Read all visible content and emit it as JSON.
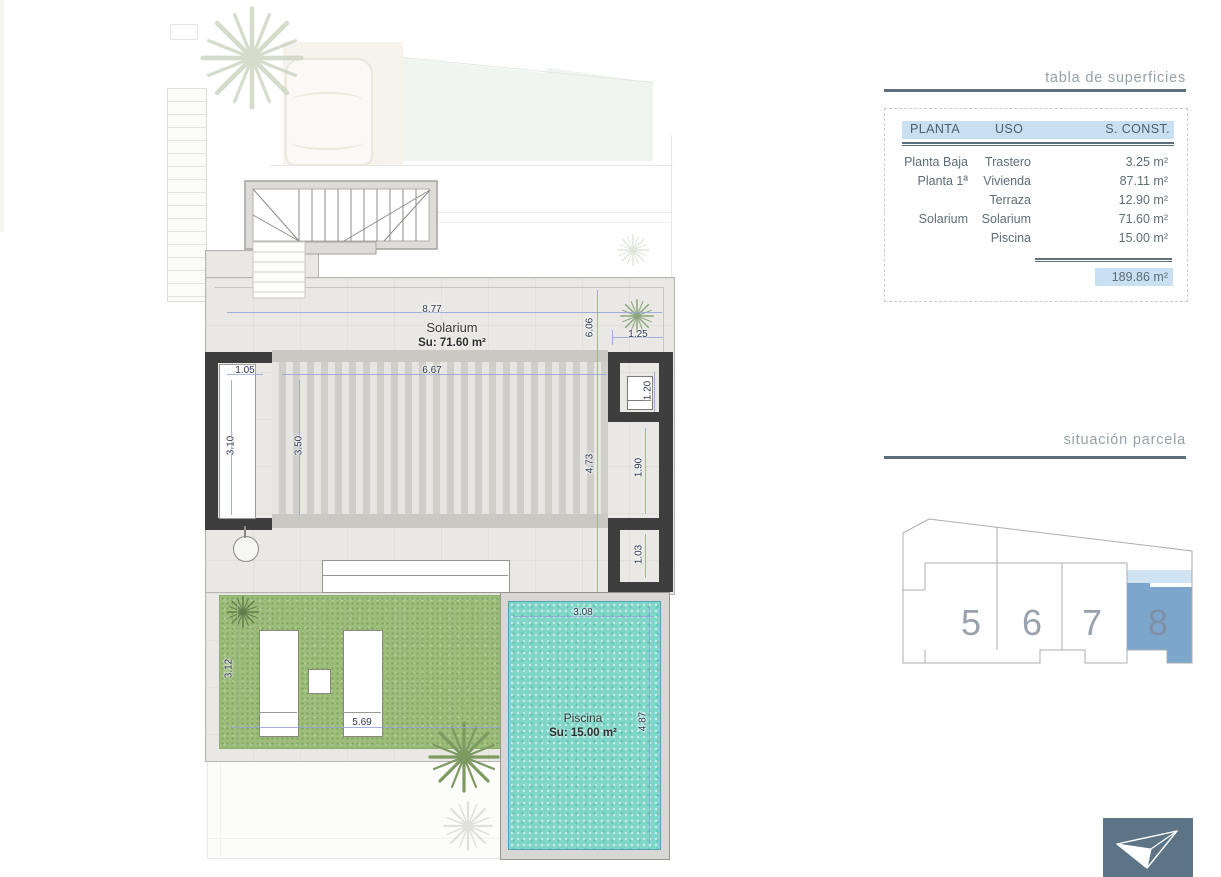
{
  "plan": {
    "rooms": {
      "solarium_label": "Solarium",
      "solarium_area": "Su: 71.60 m²",
      "pool_label": "Piscina",
      "pool_area": "Su: 15.00 m²"
    },
    "dims": {
      "d877": "8.77",
      "d606": "6.06",
      "d125": "1.25",
      "d667": "6.67",
      "d105": "1.05",
      "d310": "3.10",
      "d350": "3.50",
      "d473": "4.73",
      "d190": "1.90",
      "d120": "1.20",
      "d103": "1.03",
      "d308": "3.08",
      "d312": "3.12",
      "d569": "5.69",
      "d487": "4.87"
    }
  },
  "surfaces_table": {
    "title": "tabla de superficies",
    "columns": [
      "PLANTA",
      "USO",
      "S. CONST."
    ],
    "rows": [
      {
        "planta": "Planta Baja",
        "uso": "Trastero",
        "sconst": "3.25 m²"
      },
      {
        "planta": "Planta 1ª",
        "uso": "Vivienda",
        "sconst": "87.11 m²"
      },
      {
        "planta": "",
        "uso": "Terraza",
        "sconst": "12.90 m²"
      },
      {
        "planta": "Solarium",
        "uso": "Solarium",
        "sconst": "71.60 m²"
      },
      {
        "planta": "",
        "uso": "Piscina",
        "sconst": "15.00 m²"
      }
    ],
    "total": "189.86 m²"
  },
  "parcela": {
    "title": "situación parcela",
    "plots": [
      "5",
      "6",
      "7",
      "8"
    ],
    "highlighted_plot": "8"
  },
  "colors": {
    "accent_blue": "#c8e0f1",
    "plot_highlight": "#7ca6cb",
    "plot_highlight_light": "#cfe3f2",
    "pool": "#7fd6c7",
    "lawn": "#9dbd7a",
    "wall": "#3e3e3e",
    "logo_bg": "#5d7487",
    "rule": "#5c6f7b"
  }
}
